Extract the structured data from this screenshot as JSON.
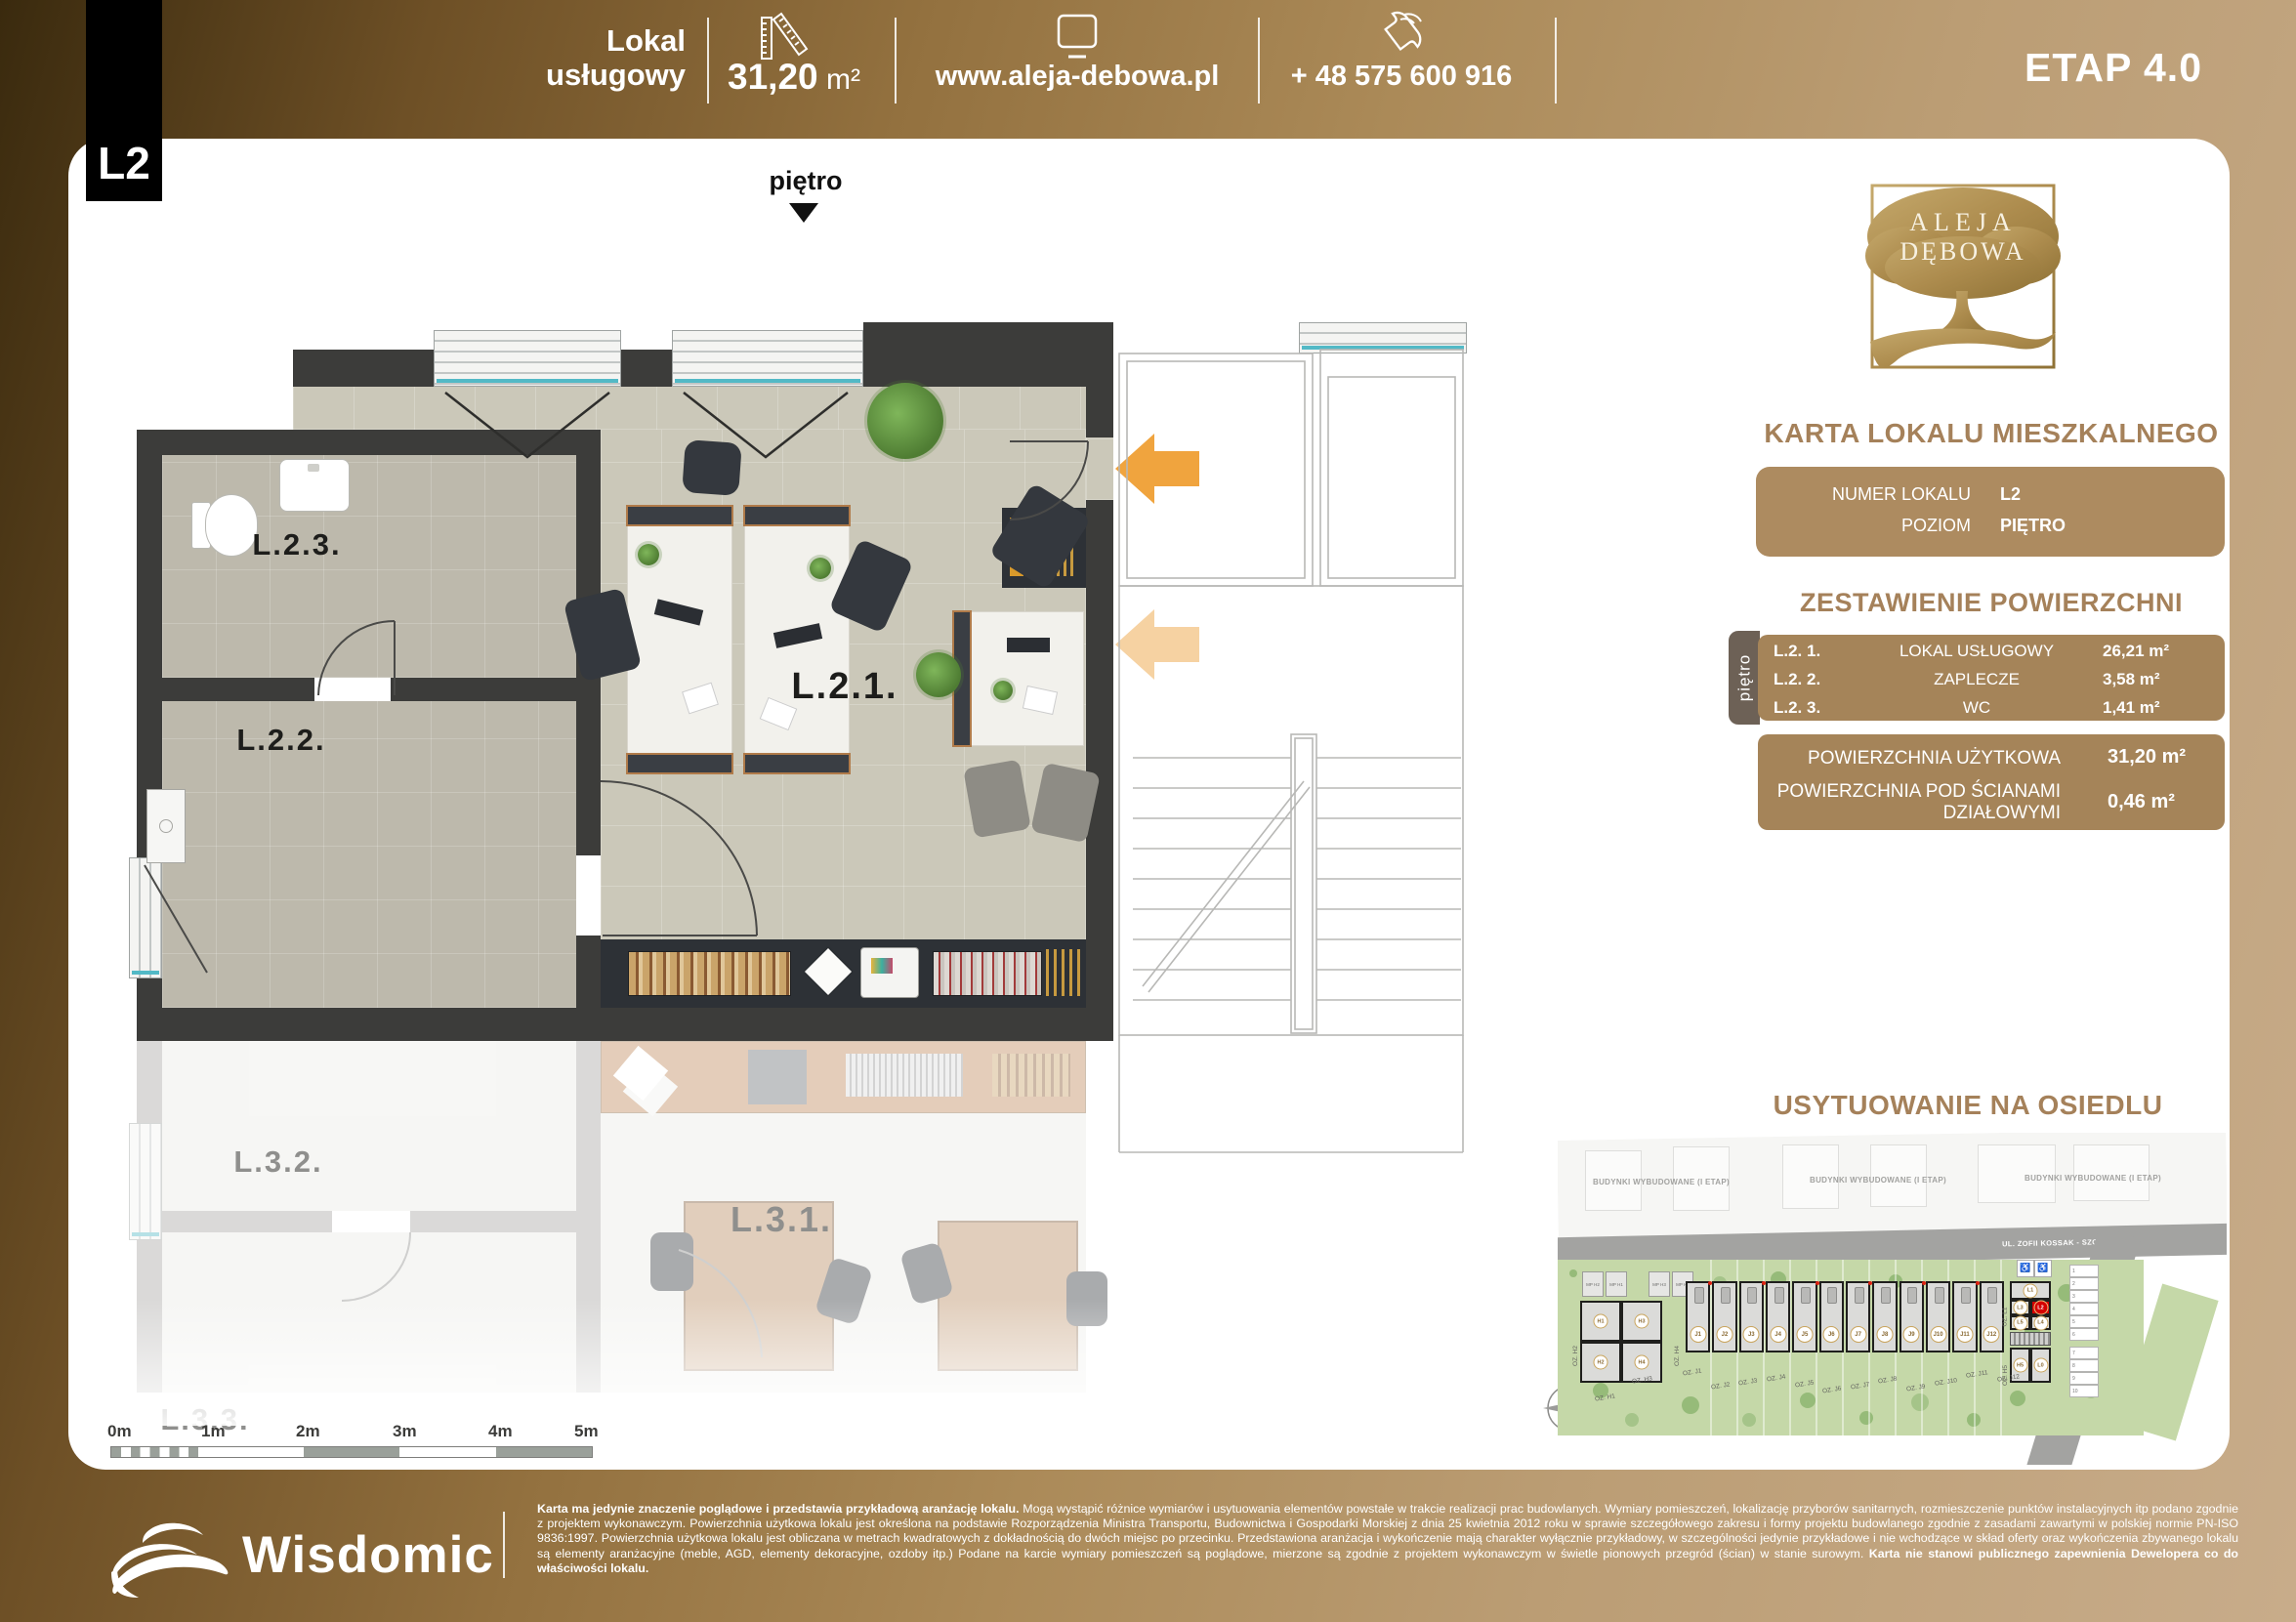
{
  "page": {
    "unit_badge": "L2",
    "etap": "ETAP 4.0"
  },
  "header": {
    "type_line1": "Lokal",
    "type_line2": "usługowy",
    "area_value": "31,20",
    "area_unit": "m²",
    "website": "www.aleja-debowa.pl",
    "phone": "+ 48 575 600 916"
  },
  "plan": {
    "level_label": "piętro",
    "rooms": [
      "L.2.1.",
      "L.2.2.",
      "L.2.3."
    ],
    "rooms_below": [
      "L.3.1.",
      "L.3.2.",
      "L.3.3."
    ]
  },
  "panel": {
    "logo": {
      "line1": "ALEJA",
      "line2": "DĘBOWA"
    },
    "title": "KARTA LOKALU MIESZKALNEGO",
    "info": {
      "numer_label": "NUMER LOKALU",
      "numer_value": "L2",
      "poziom_label": "POZIOM",
      "poziom_value": "PIĘTRO"
    },
    "areas_title": "ZESTAWIENIE POWIERZCHNI",
    "floor_tab": "piętro",
    "rooms": [
      {
        "id": "L.2. 1.",
        "name": "LOKAL USŁUGOWY",
        "area": "26,21 m²"
      },
      {
        "id": "L.2. 2.",
        "name": "ZAPLECZE",
        "area": "3,58 m²"
      },
      {
        "id": "L.2. 3.",
        "name": "WC",
        "area": "1,41 m²"
      }
    ],
    "totals": [
      {
        "label": "POWIERZCHNIA UŻYTKOWA",
        "value": "31,20 m²"
      },
      {
        "label": "POWIERZCHNIA POD ŚCIANAMI  DZIAŁOWYMI",
        "value": "0,46 m²"
      }
    ]
  },
  "sitemap": {
    "title": "USYTUOWANIE NA OSIEDLU",
    "built_label": "BUDYNKI WYBUDOWANE (I ETAP)",
    "street_top": "UL. ZOFII KOSSAK - SZCZUCKIEJ",
    "street_right": "UL. FELIKSA WRÓBLA",
    "h_units": [
      "H1",
      "H3",
      "H2",
      "H4"
    ],
    "j_units": [
      "J1",
      "J2",
      "J3",
      "J4",
      "J5",
      "J6",
      "J7",
      "J8",
      "J9",
      "J10",
      "J11",
      "J12"
    ],
    "l_units": {
      "top": "L1",
      "row2": [
        "L3",
        "L2"
      ],
      "row3": [
        "L5",
        "L4"
      ],
      "bottom": [
        "H5",
        "L0"
      ],
      "highlighted": "L2"
    },
    "mp_labels": [
      "MP H2",
      "MP H1",
      "MP H3",
      "MP H4"
    ],
    "oz_j": [
      "OZ. J1",
      "OZ. J2",
      "OZ. J3",
      "OZ. J4",
      "OZ. J5",
      "OZ. J6",
      "OZ. J7",
      "OZ. J8",
      "OZ. J9",
      "OZ. J10",
      "OZ. J11",
      "OZ. J12"
    ],
    "oz_other": [
      "OZ. H1",
      "OZ. H3",
      "OZ. H2",
      "OZ. H4",
      "OZ. L1",
      "OZ. H5"
    ],
    "parking": [
      "1",
      "2",
      "3",
      "4",
      "5",
      "6",
      "7",
      "8",
      "9",
      "10"
    ]
  },
  "scalebar": {
    "labels": [
      "0m",
      "1m",
      "2m",
      "3m",
      "4m",
      "5m"
    ]
  },
  "footer": {
    "brand": "Wisdomic",
    "disclaimer_intro": "Karta ma jedynie znaczenie poglądowe i przedstawia przykładową  aranżację lokalu.",
    "disclaimer_body": " Mogą wystąpić różnice wymiarów i usytuowania elementów powstałe w trakcie realizacji prac budowlanych. Wymiary pomieszczeń, lokalizację przyborów sanitarnych, rozmieszczenie punktów instalacyjnych itp podano zgodnie z projektem wykonawczym. Powierzchnia użytkowa lokalu jest określona na podstawie Rozporządzenia Ministra Transportu, Budownictwa i Gospodarki Morskiej z dnia 25 kwietnia 2012 roku w sprawie szczegółowego zakresu i formy projektu budowlanego zgodnie z zasadami zawartymi w polskiej normie PN-ISO 9836:1997. Powierzchnia użytkowa lokalu jest obliczana w metrach kwadratowych z dokładnością do dwóch miejsc po przecinku. Przedstawiona aranżacja i wykończenie mają charakter wyłącznie przykładowy, w szczególności jedynie przykładowe i nie wchodzące w skład oferty oraz wykończenia zbywanego lokalu są elementy aranżacyjne (meble, AGD, elementy dekoracyjne, ozdoby itp.) Podane na karcie wymiary pomieszczeń są poglądowe, mierzone są zgodnie z projektem wykonawczym w świetle pionowych przegród (ścian) w stanie surowym.",
    "disclaimer_tail": " Karta nie stanowi publicznego zapewnienia Dewelopera co do właściwości lokalu."
  },
  "colors": {
    "accent": "#a5815a",
    "panel_brown": "#a58459",
    "panel_tab_brown": "#6d6156",
    "arrow_orange": "#f0a43e",
    "highlight_red": "#d40000",
    "site_green": "#c5d8a8",
    "wall_dark": "#3c3c3a"
  },
  "icons": [
    "folding-ruler-icon",
    "monitor-icon",
    "phone-handset-icon",
    "down-triangle-icon",
    "compass-rose-icon",
    "wisdomic-wave-icon",
    "aleja-debowa-tree-logo"
  ]
}
